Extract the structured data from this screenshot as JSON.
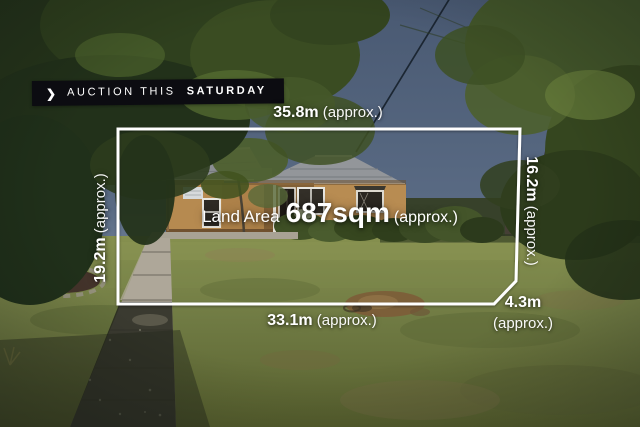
{
  "banner": {
    "chevron": "❯",
    "text_regular": "AUCTION THIS",
    "text_bold": "SATURDAY"
  },
  "land_area": {
    "prefix": "Land Area",
    "value": "687sqm",
    "suffix": "(approx.)"
  },
  "measurements": {
    "top": {
      "value": "35.8m",
      "suffix": "(approx.)"
    },
    "bottom": {
      "value": "33.1m",
      "suffix": "(approx.)"
    },
    "left": {
      "value": "19.2m",
      "suffix": "(approx.)"
    },
    "right": {
      "value": "16.2m",
      "suffix": "(approx.)"
    },
    "corner": {
      "value": "4.3m",
      "suffix": "(approx.)"
    }
  },
  "colors": {
    "boundary_line": "#ffffff",
    "label_text": "#ffffff",
    "banner_bg": "#0c0c11",
    "banner_text": "#ffffff"
  }
}
